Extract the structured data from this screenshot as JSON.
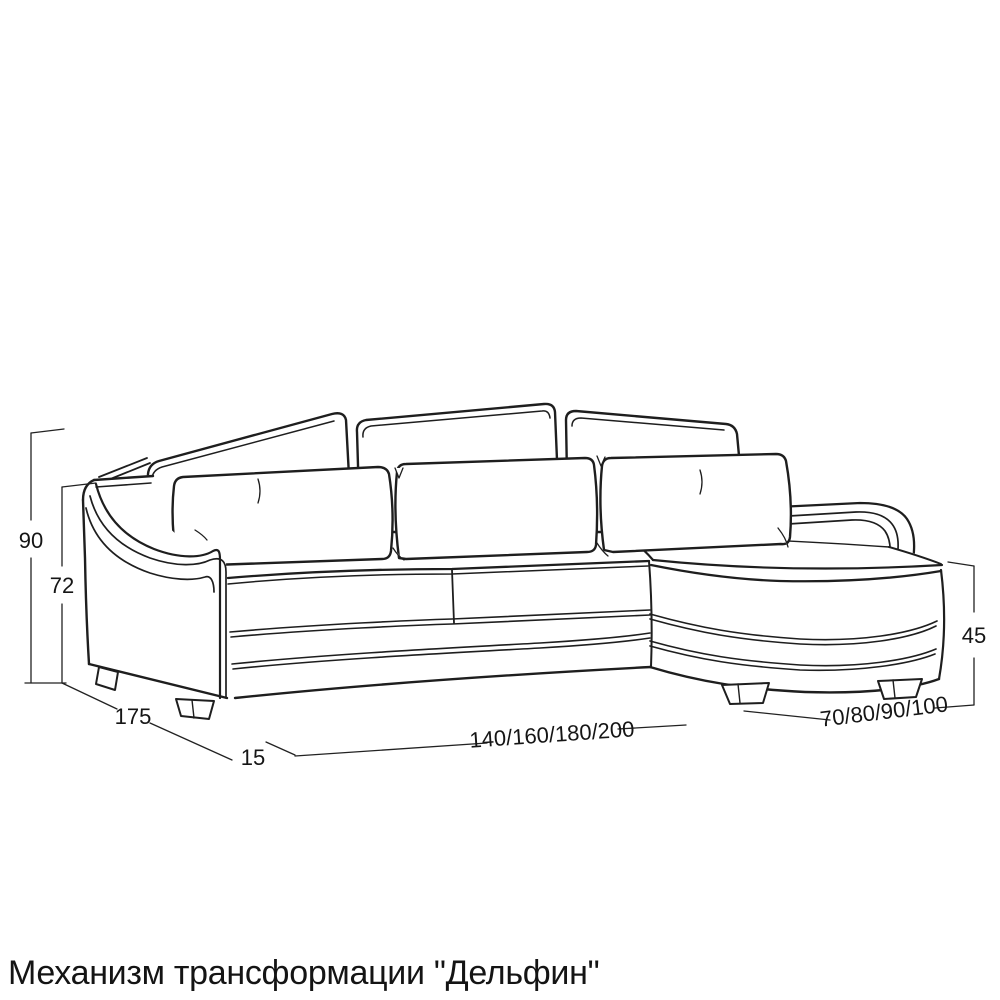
{
  "diagram": {
    "caption": "Механизм трансформации \"Дельфин\"",
    "dimensions": {
      "total_height": "90",
      "armrest_height": "72",
      "depth": "175",
      "armrest_width": "15",
      "length_options": "140/160/180/200",
      "chaise_options": "70/80/90/100",
      "seat_height": "45"
    },
    "colors": {
      "line": "#1e1e1e",
      "dimension_line": "#222222",
      "background": "#ffffff"
    }
  }
}
